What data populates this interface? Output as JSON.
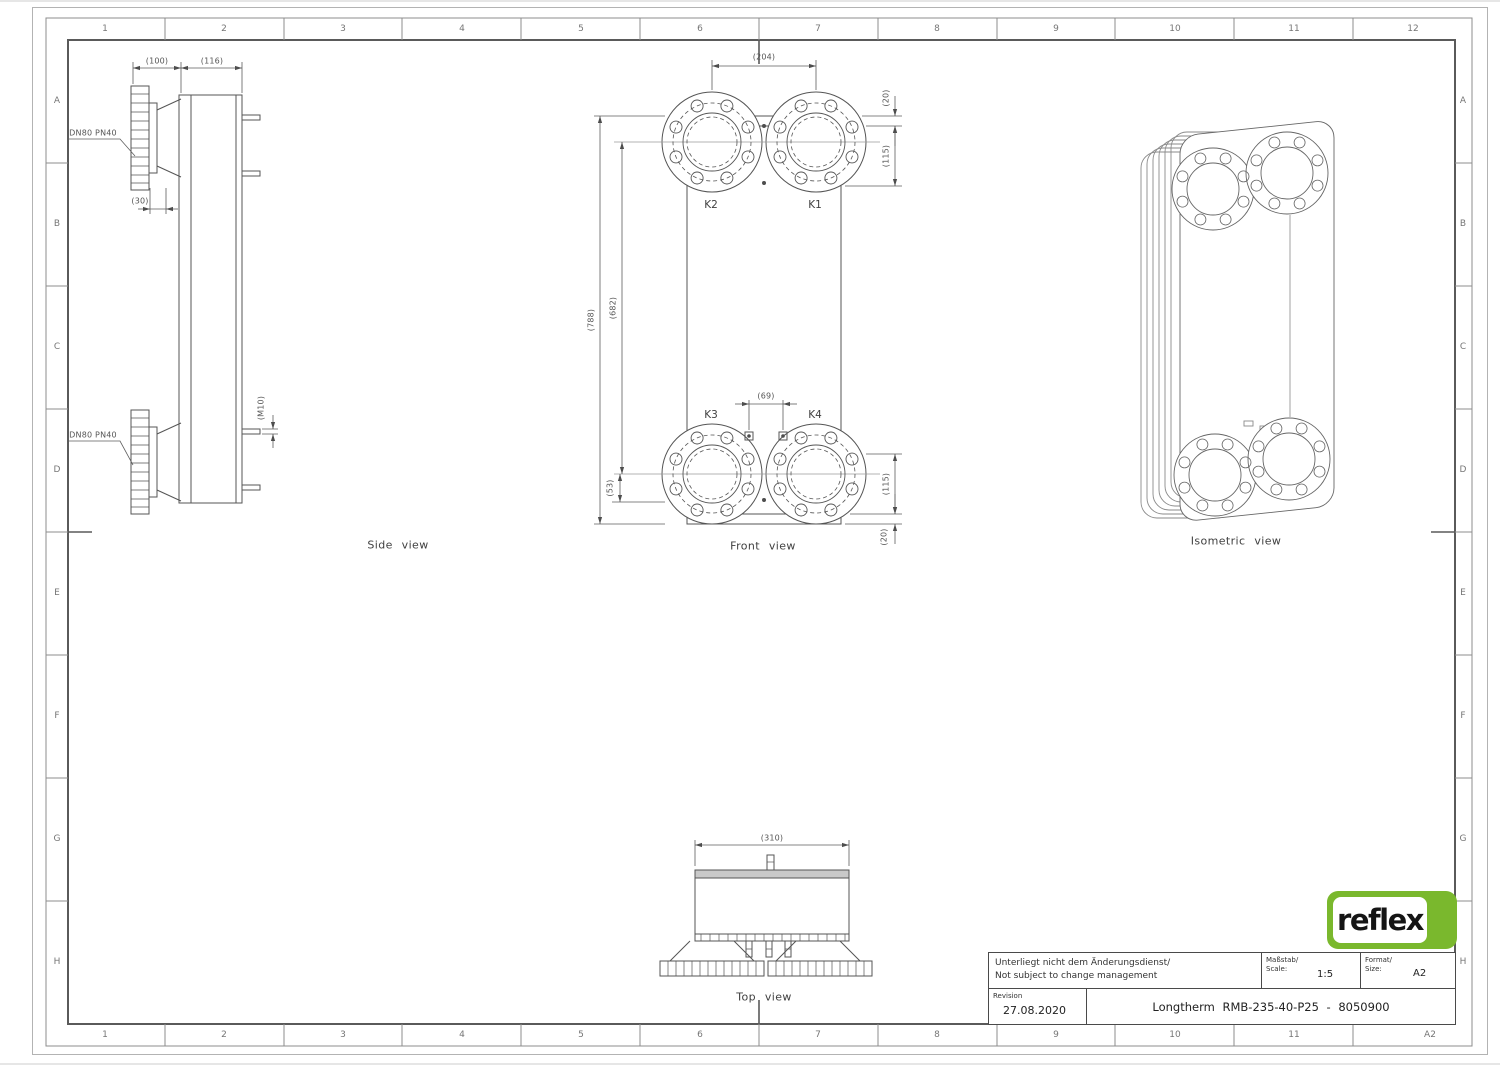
{
  "frame": {
    "cols_top": [
      "1",
      "2",
      "3",
      "4",
      "5",
      "6",
      "7",
      "8",
      "9",
      "10",
      "11",
      "12"
    ],
    "cols_bottom": [
      "1",
      "2",
      "3",
      "4",
      "5",
      "6",
      "7",
      "8",
      "9",
      "10",
      "11",
      "A2"
    ],
    "rows_left": [
      "A",
      "B",
      "C",
      "D",
      "E",
      "F",
      "G",
      "H"
    ],
    "rows_right": [
      "A",
      "B",
      "C",
      "D",
      "E",
      "F",
      "G",
      "H"
    ]
  },
  "views": {
    "side": {
      "label": "Side view",
      "flange_top_label": "DN80 PN40",
      "flange_bottom_label": "DN80 PN40",
      "dim_100": "(100)",
      "dim_116": "(116)",
      "dim_30": "(30)",
      "dim_m10": "(M10)"
    },
    "front": {
      "label": "Front view",
      "dim_204": "(204)",
      "dim_20_top": "(20)",
      "dim_115_top": "(115)",
      "dim_115_bottom": "(115)",
      "dim_20_bottom": "(20)",
      "dim_53": "(53)",
      "dim_69": "(69)",
      "dim_788": "(788)",
      "dim_682": "(682)",
      "port_k1": "K1",
      "port_k2": "K2",
      "port_k3": "K3",
      "port_k4": "K4"
    },
    "top": {
      "label": "Top view",
      "dim_310": "(310)"
    },
    "iso": {
      "label": "Isometric view"
    }
  },
  "title_block": {
    "note_line1": "Unterliegt nicht dem Änderungsdienst/",
    "note_line2": "Not subject to change management",
    "scale_label1": "Maßstab/",
    "scale_label2": "Scale:",
    "scale_value": "1:5",
    "format_label1": "Format/",
    "format_label2": "Size:",
    "format_value": "A2",
    "revision_label": "Revision",
    "revision_date": "27.08.2020",
    "drawing_title": "Longtherm RMB-235-40-P25 - 8050900"
  },
  "logo": {
    "text": "reflex",
    "brand_green": "#7ab82d"
  }
}
